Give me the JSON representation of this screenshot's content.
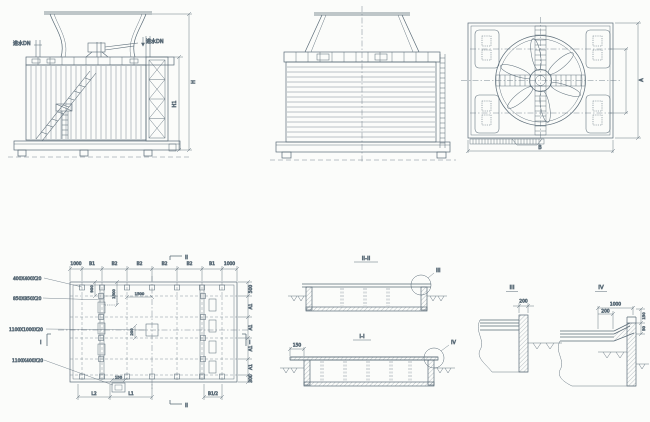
{
  "meta": {
    "bg_color": "#fbfcfa",
    "line_color": "#5a6b77",
    "text_color": "#44525c",
    "drawing_type": "cooling-tower-general-arrangement"
  },
  "side_elevation": {
    "inlet_left": "进水DN",
    "inlet_right": "进水DN",
    "dim_total_height": "H",
    "dim_casing_height": "H1"
  },
  "plan_view": {
    "dim_width": "B",
    "dim_depth": "A"
  },
  "foundation_plan": {
    "top_dims": [
      "1000",
      "B1",
      "B2",
      "B2",
      "B2",
      "B2",
      "B1",
      "1000"
    ],
    "right_dims": [
      "500",
      "A1",
      "A1",
      "A1",
      "A1",
      "300"
    ],
    "bottom_dims": [
      "L2",
      "L1"
    ],
    "half_dim": "B1/2",
    "anchor_dim": "150",
    "leaders": [
      "400X400X20",
      "850X850X20",
      "1100X1000X20",
      "1100X400X20"
    ],
    "dim_900": "900",
    "dim_1500_vertical": "1500",
    "dim_1500_horizontal": "1500",
    "dim_200": "200",
    "marks": {
      "I": "I",
      "II": "II"
    }
  },
  "sections": {
    "s2_title": "II-II",
    "s1_title": "I-I",
    "s1_overhang_dim": "150",
    "ref_III": "III",
    "ref_IV": "IV"
  },
  "details": {
    "d3_title": "III",
    "d3_dim_200": "200",
    "d4_title": "IV",
    "d4_dim_1000": "1000",
    "d4_dim_200": "200",
    "d4_dim_150": "150",
    "d4_dim_50": "50"
  }
}
